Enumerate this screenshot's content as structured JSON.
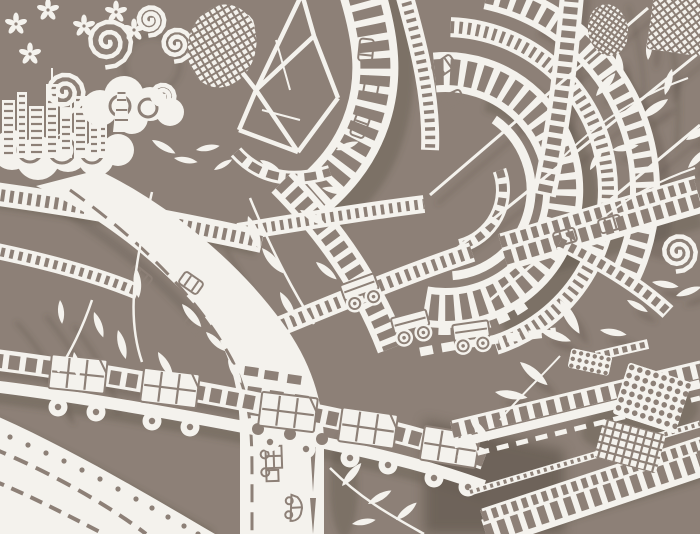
{
  "meta": {
    "artwork_type": "white paper-cut artwork photographed on a taupe board",
    "scene": "tangled interchange of elevated highways, rollercoaster-like loops and bridges carrying cars, trucks and cart-like vehicles, with clouds, a small city skyline, flowers, vines and leaves"
  },
  "palette": {
    "background": "#8d8077",
    "background_dark": "#695e55",
    "shadow": "#564b42",
    "paper": "#f4f2ed",
    "paper_bright": "#ffffff"
  },
  "elements": {
    "leaves": [
      [
        596,
        96,
        40,
        1,
        1
      ],
      [
        622,
        78,
        -10,
        0.9,
        1
      ],
      [
        641,
        118,
        55,
        1.1,
        1
      ],
      [
        665,
        95,
        15,
        0.9,
        1
      ],
      [
        686,
        140,
        60,
        1,
        1
      ],
      [
        612,
        150,
        80,
        0.9,
        1
      ],
      [
        590,
        170,
        30,
        0.8,
        1
      ],
      [
        688,
        168,
        45,
        0.9,
        1
      ],
      [
        648,
        60,
        5,
        0.8,
        1
      ],
      [
        652,
        282,
        100,
        0.9,
        1
      ],
      [
        676,
        296,
        70,
        0.9,
        1
      ],
      [
        627,
        300,
        120,
        0.8,
        1
      ],
      [
        695,
        210,
        80,
        0.8,
        1
      ],
      [
        520,
        362,
        130,
        1.2,
        1
      ],
      [
        495,
        392,
        100,
        1.1,
        1
      ],
      [
        470,
        418,
        140,
        1,
        1
      ],
      [
        540,
        330,
        110,
        1.1,
        1
      ],
      [
        560,
        300,
        150,
        1.3,
        1
      ],
      [
        600,
        330,
        100,
        0.9,
        1
      ],
      [
        248,
        216,
        160,
        1.2,
        0
      ],
      [
        262,
        248,
        140,
        1.1,
        0
      ],
      [
        238,
        276,
        170,
        1.1,
        0
      ],
      [
        280,
        292,
        150,
        1,
        0
      ],
      [
        300,
        210,
        120,
        1,
        0
      ],
      [
        322,
        188,
        100,
        0.9,
        0
      ],
      [
        316,
        262,
        130,
        0.9,
        0
      ],
      [
        152,
        204,
        170,
        1,
        0
      ],
      [
        168,
        242,
        150,
        1,
        0
      ],
      [
        136,
        268,
        175,
        1,
        0
      ],
      [
        182,
        304,
        140,
        1,
        0
      ],
      [
        118,
        330,
        165,
        1,
        0
      ],
      [
        158,
        352,
        150,
        1,
        0
      ],
      [
        94,
        312,
        160,
        0.9,
        0
      ],
      [
        74,
        352,
        170,
        0.9,
        0
      ],
      [
        60,
        300,
        175,
        0.8,
        0
      ],
      [
        206,
        332,
        135,
        0.9,
        0
      ],
      [
        228,
        360,
        150,
        0.9,
        0
      ],
      [
        342,
        486,
        40,
        1,
        0
      ],
      [
        368,
        504,
        60,
        0.9,
        0
      ],
      [
        396,
        520,
        50,
        0.9,
        0
      ],
      [
        352,
        524,
        80,
        0.8,
        0
      ],
      [
        152,
        140,
        120,
        0.9,
        0
      ],
      [
        174,
        158,
        100,
        0.8,
        0
      ],
      [
        196,
        150,
        80,
        0.8,
        0
      ],
      [
        214,
        170,
        60,
        0.7,
        0
      ],
      [
        336,
        150,
        70,
        0.8,
        0
      ],
      [
        260,
        160,
        120,
        0.8,
        0
      ]
    ],
    "track_cars": [
      [
        366,
        50,
        96
      ],
      [
        371,
        88,
        101
      ],
      [
        360,
        126,
        110
      ],
      [
        444,
        66,
        -35
      ],
      [
        452,
        100,
        -25
      ],
      [
        140,
        277,
        38
      ],
      [
        191,
        283,
        35
      ],
      [
        196,
        326,
        42
      ],
      [
        565,
        237,
        -16
      ],
      [
        610,
        224,
        -16
      ]
    ],
    "side_vehicles": [
      [
        274,
        464,
        88,
        "truck"
      ],
      [
        295,
        508,
        92,
        "car"
      ]
    ],
    "carts": [
      [
        78,
        374,
        6
      ],
      [
        170,
        388,
        7
      ],
      [
        288,
        412,
        7
      ],
      [
        368,
        428,
        8
      ],
      [
        450,
        447,
        9
      ]
    ],
    "wheels": [
      [
        58,
        407
      ],
      [
        96,
        412
      ],
      [
        152,
        421
      ],
      [
        190,
        427
      ],
      [
        270,
        442
      ],
      [
        306,
        449
      ],
      [
        350,
        458
      ],
      [
        388,
        465
      ],
      [
        434,
        478
      ],
      [
        468,
        487
      ]
    ],
    "deck_holes": [
      [
        258,
        429
      ],
      [
        290,
        434
      ],
      [
        322,
        439
      ]
    ],
    "spoke_trucks": [
      [
        352,
        296,
        -20
      ],
      [
        402,
        330,
        -15
      ],
      [
        462,
        338,
        -8
      ]
    ],
    "buildings": [
      [
        2,
        100,
        13,
        58,
        0
      ],
      [
        17,
        92,
        10,
        66,
        0
      ],
      [
        29,
        106,
        15,
        52,
        0
      ],
      [
        46,
        84,
        12,
        74,
        1
      ],
      [
        60,
        102,
        12,
        56,
        0
      ],
      [
        74,
        96,
        13,
        62,
        0
      ],
      [
        89,
        112,
        10,
        46,
        0
      ],
      [
        99,
        118,
        8,
        40,
        0
      ]
    ],
    "roses": [
      [
        108,
        42,
        26
      ],
      [
        150,
        20,
        16
      ],
      [
        64,
        92,
        22
      ],
      [
        162,
        96,
        14
      ],
      [
        176,
        44,
        18
      ],
      [
        678,
        252,
        20
      ],
      [
        240,
        26,
        14
      ]
    ],
    "flowers": [
      [
        16,
        24
      ],
      [
        48,
        10
      ],
      [
        84,
        26
      ],
      [
        116,
        12
      ],
      [
        30,
        54
      ],
      [
        134,
        30
      ]
    ],
    "rays": [
      [
        455,
        250,
        700,
        52
      ],
      [
        490,
        300,
        700,
        125
      ],
      [
        430,
        195,
        648,
        8
      ]
    ],
    "patches": [
      {
        "type": "net",
        "shape": "ellipse",
        "cx": 222,
        "cy": 46,
        "rx": 34,
        "ry": 42,
        "rot": 14,
        "sp": 9
      },
      {
        "type": "net",
        "shape": "ellipse",
        "cx": 608,
        "cy": 30,
        "rx": 20,
        "ry": 26,
        "rot": -10,
        "sp": 7
      },
      {
        "type": "net",
        "shape": "rect",
        "cx": 678,
        "cy": 24,
        "w": 56,
        "h": 58,
        "rot": 8,
        "sp": 8.5
      },
      {
        "type": "dots",
        "shape": "rect",
        "cx": 590,
        "cy": 362,
        "w": 42,
        "h": 20,
        "rot": 12,
        "sp": 7,
        "r": 2.2
      },
      {
        "type": "dots",
        "shape": "rect",
        "cx": 652,
        "cy": 398,
        "w": 66,
        "h": 54,
        "rot": 18,
        "sp": 8.5,
        "r": 2.8
      },
      {
        "type": "check",
        "shape": "rect",
        "cx": 630,
        "cy": 446,
        "w": 64,
        "h": 40,
        "rot": 15,
        "sp": 8
      }
    ],
    "ramp_dots": [
      [
        10,
        437
      ],
      [
        28,
        445
      ],
      [
        46,
        453
      ],
      [
        64,
        461
      ],
      [
        82,
        470
      ],
      [
        100,
        479
      ],
      [
        118,
        489
      ],
      [
        136,
        499
      ],
      [
        152,
        508
      ],
      [
        168,
        517
      ],
      [
        184,
        526
      ],
      [
        198,
        534
      ]
    ],
    "panel_holes": [
      [
        245,
        366
      ],
      [
        265,
        370
      ],
      [
        288,
        374
      ],
      [
        248,
        386
      ],
      [
        270,
        390
      ],
      [
        295,
        394
      ],
      [
        250,
        406
      ],
      [
        274,
        410
      ]
    ]
  }
}
